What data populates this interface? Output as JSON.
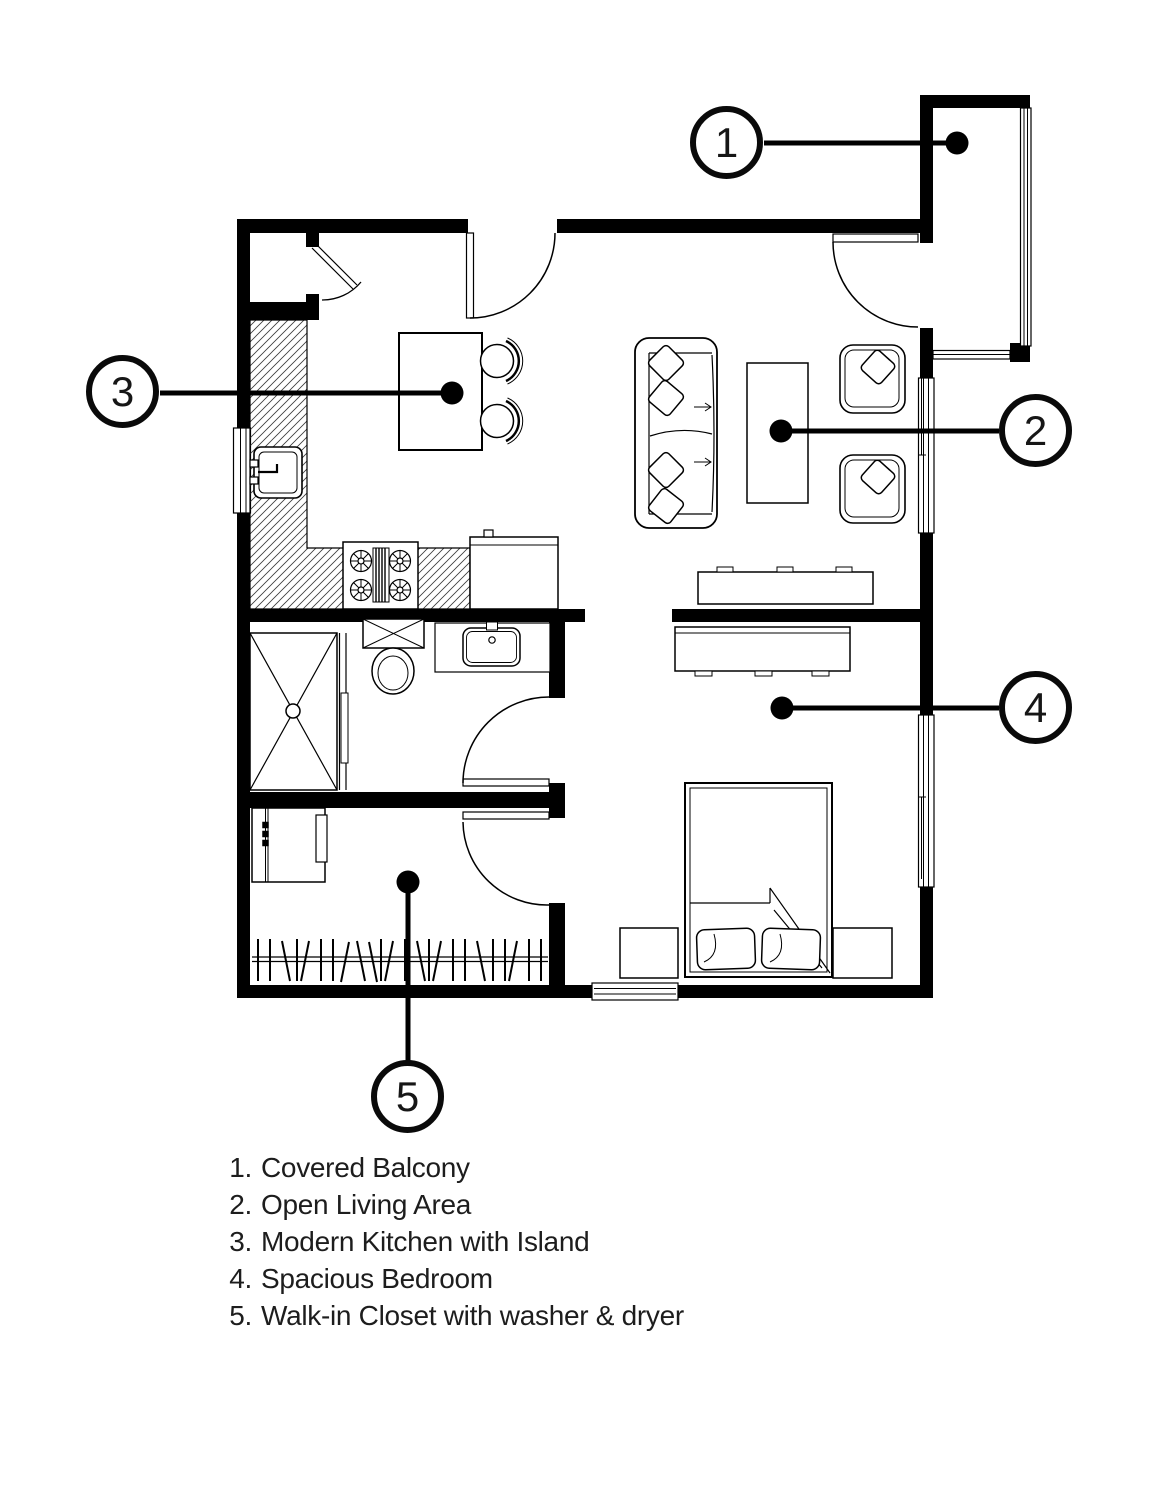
{
  "plan": {
    "background_color": "#ffffff",
    "line_color": "#000000",
    "text_color": "#1d1d1d"
  },
  "callouts": [
    {
      "number": "1",
      "label": "Covered Balcony"
    },
    {
      "number": "2",
      "label": "Open Living Area"
    },
    {
      "number": "3",
      "label": "Modern Kitchen with Island"
    },
    {
      "number": "4",
      "label": "Spacious Bedroom"
    },
    {
      "number": "5",
      "label": "Walk-in Closet with washer & dryer"
    }
  ],
  "legend": {
    "items": [
      {
        "number": "1.",
        "label": "Covered Balcony"
      },
      {
        "number": "2.",
        "label": "Open Living Area"
      },
      {
        "number": "3.",
        "label": "Modern Kitchen with Island"
      },
      {
        "number": "4.",
        "label": "Spacious Bedroom"
      },
      {
        "number": "5.",
        "label": "Walk-in Closet with washer & dryer"
      }
    ]
  }
}
